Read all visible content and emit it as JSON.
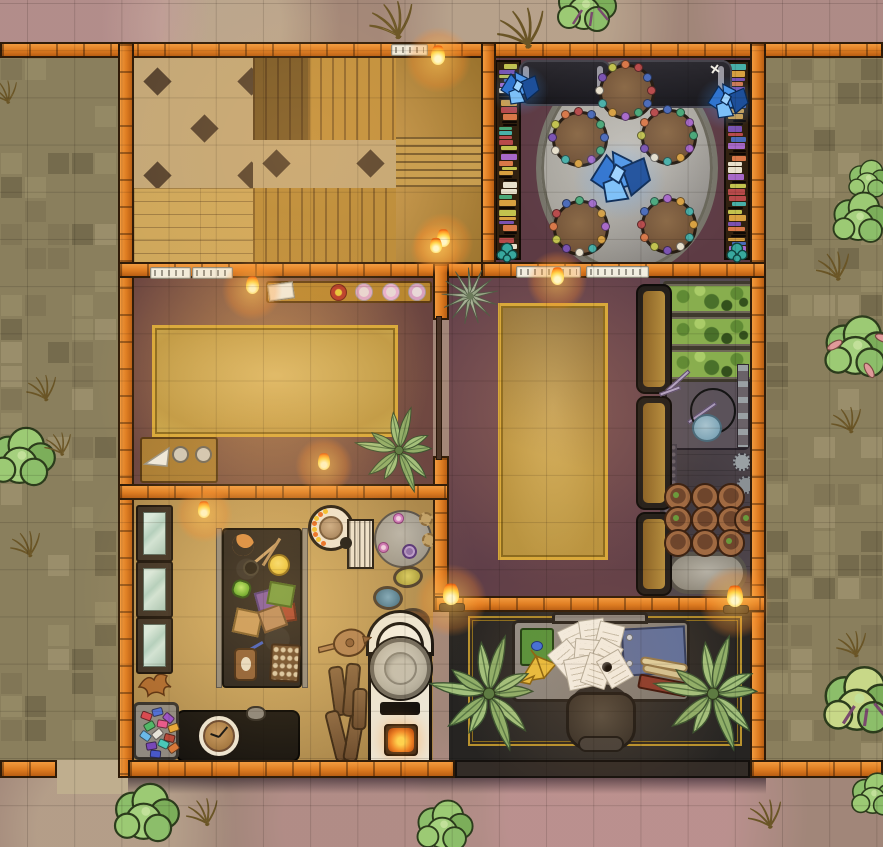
{
  "map": {
    "width": 883,
    "height": 847,
    "grid_px": 47.2,
    "style": "top-down fantasy battlemap, walled guild house with courtyards"
  },
  "palette": {
    "wall_orange": "#dd7b20",
    "wall_outline": "#2f1b08",
    "dirt": "#a18679",
    "dirt_light": "#c0ad93",
    "dirt_pink": "#c795a0",
    "path_tan": "#bfae8e",
    "cobble": "#8a7f5d",
    "hall_wood": "#c2913e",
    "checker_tan": "#c4a878",
    "checker_dark": "#584430",
    "library_floor": "#5d3b44",
    "oval_rug": "#b5b2aa",
    "bench_black": "#232127",
    "dining_floor": "#6e4743",
    "lounge_floor": "#66414e",
    "rug_gold": "#cfa94e",
    "rug_trim": "#d8a93a",
    "greenhouse_floor": "#554b52",
    "bed_green": "#88ae4e",
    "pot_terracotta": "#a06a42",
    "workshop_floor": "#b39250",
    "craft_table_black": "#201c1a",
    "glass": "#bcd8cc",
    "kiln_white": "#ece6d6",
    "office_floor": "#2d2b29",
    "desk_gray": "#8b8681",
    "crystal_blue": "#3f8ae0",
    "flame_orange": "#ff9422",
    "fern_green": "#8fae69",
    "bush_green": "#8cbe6a",
    "teal_plant": "#38a89e",
    "wheat_tan": "#d4b874"
  },
  "rooms": [
    {
      "id": "hall",
      "x": 134,
      "y": 58,
      "w": 347,
      "h": 204
    },
    {
      "id": "library",
      "x": 496,
      "y": 58,
      "w": 254,
      "h": 204
    },
    {
      "id": "dining",
      "x": 134,
      "y": 278,
      "w": 299,
      "h": 206
    },
    {
      "id": "lounge",
      "x": 449,
      "y": 278,
      "w": 211,
      "h": 318
    },
    {
      "id": "greenhouse",
      "x": 660,
      "y": 278,
      "w": 90,
      "h": 318
    },
    {
      "id": "workshop",
      "x": 134,
      "y": 500,
      "w": 299,
      "h": 262
    },
    {
      "id": "office",
      "x": 449,
      "y": 612,
      "w": 301,
      "h": 150
    }
  ],
  "walls": [
    {
      "x": 0,
      "y": 42,
      "w": 883,
      "h": 16,
      "v": 0
    },
    {
      "x": 118,
      "y": 42,
      "w": 16,
      "h": 736,
      "v": 1
    },
    {
      "x": 750,
      "y": 42,
      "w": 16,
      "h": 736,
      "v": 1
    },
    {
      "x": 481,
      "y": 42,
      "w": 15,
      "h": 236,
      "v": 1
    },
    {
      "x": 118,
      "y": 262,
      "w": 378,
      "h": 16,
      "v": 0
    },
    {
      "x": 481,
      "y": 262,
      "w": 285,
      "h": 16,
      "v": 0
    },
    {
      "x": 433,
      "y": 262,
      "w": 16,
      "h": 58,
      "v": 1
    },
    {
      "x": 433,
      "y": 456,
      "w": 16,
      "h": 156,
      "v": 1
    },
    {
      "x": 118,
      "y": 484,
      "w": 331,
      "h": 16,
      "v": 0
    },
    {
      "x": 433,
      "y": 596,
      "w": 333,
      "h": 16,
      "v": 0
    },
    {
      "x": 0,
      "y": 760,
      "w": 57,
      "h": 18,
      "v": 0
    },
    {
      "x": 128,
      "y": 760,
      "w": 327,
      "h": 18,
      "v": 0
    },
    {
      "x": 455,
      "y": 760,
      "w": 295,
      "h": 18,
      "v": 0,
      "dark": 1
    },
    {
      "x": 750,
      "y": 760,
      "w": 133,
      "h": 18,
      "v": 0
    }
  ],
  "scene": {
    "yards": [
      {
        "x": 0,
        "y": 58,
        "w": 118,
        "h": 702,
        "seed": 7
      },
      {
        "x": 766,
        "y": 58,
        "w": 117,
        "h": 702,
        "seed": 13
      }
    ],
    "flames": [
      {
        "x": 438,
        "y": 58,
        "s": 1.1
      },
      {
        "x": 443,
        "y": 241,
        "s": 1.0
      },
      {
        "x": 252,
        "y": 288,
        "s": 1.0
      },
      {
        "x": 557,
        "y": 279,
        "s": 1.0
      },
      {
        "x": 436,
        "y": 248,
        "s": 0.85
      },
      {
        "x": 324,
        "y": 464,
        "s": 0.95
      },
      {
        "x": 204,
        "y": 512,
        "s": 0.95
      },
      {
        "x": 451,
        "y": 598,
        "s": 1.2
      },
      {
        "x": 735,
        "y": 600,
        "s": 1.2
      }
    ],
    "trims": [
      {
        "x": 150,
        "y": 267,
        "w": 39
      },
      {
        "x": 192,
        "y": 267,
        "w": 39
      },
      {
        "x": 516,
        "y": 266,
        "w": 63
      },
      {
        "x": 586,
        "y": 266,
        "w": 61
      },
      {
        "x": 391,
        "y": 44,
        "w": 35
      }
    ],
    "library": {
      "tables": [
        {
          "x": 624,
          "y": 89
        },
        {
          "x": 577,
          "y": 136
        },
        {
          "x": 666,
          "y": 134
        },
        {
          "x": 578,
          "y": 225
        },
        {
          "x": 666,
          "y": 223
        }
      ],
      "table_r": 25,
      "crystals": [
        {
          "x": 519,
          "y": 90,
          "s": 1.0
        },
        {
          "x": 727,
          "y": 103,
          "s": 1.05
        },
        {
          "x": 619,
          "y": 180,
          "s": 1.55
        }
      ],
      "benches": [
        {
          "x": 519,
          "y": 60,
          "w": 88,
          "h": 42
        },
        {
          "x": 616,
          "y": 60,
          "w": 112,
          "h": 44
        }
      ],
      "shelves": [
        {
          "x": 495,
          "y": 60,
          "w": 26,
          "h": 200
        },
        {
          "x": 724,
          "y": 60,
          "w": 26,
          "h": 200
        }
      ],
      "spine_colors": [
        "#b84a4a",
        "#4a6ab8",
        "#4aa878",
        "#a868c8",
        "#d8a040",
        "#48b0a8",
        "#e8e0cc",
        "#7a52b0",
        "#c2c24e",
        "#d87848"
      ]
    },
    "kitchen": {
      "beds": [
        {
          "x": 663,
          "y": 281
        },
        {
          "x": 663,
          "y": 314
        },
        {
          "x": 663,
          "y": 347
        }
      ],
      "bed_w": 88,
      "bed_h": 29,
      "pots": [
        [
          676,
          495
        ],
        [
          703,
          495
        ],
        [
          729,
          495
        ],
        [
          676,
          518
        ],
        [
          703,
          518
        ],
        [
          729,
          518
        ],
        [
          746,
          518
        ],
        [
          676,
          541
        ],
        [
          703,
          541
        ],
        [
          729,
          541
        ]
      ],
      "pot_r": 12,
      "booths": [
        {
          "y": 284,
          "h": 106
        },
        {
          "y": 396,
          "h": 110
        },
        {
          "y": 512,
          "h": 80
        }
      ],
      "booth_x": 636,
      "booth_w": 32
    },
    "workshop": {
      "cases": [
        505,
        561,
        617
      ],
      "case_x": 136,
      "case_w": 33,
      "case_h": 53,
      "dial": {
        "cx": 331,
        "cy": 528,
        "r": 17
      },
      "gems": [
        {
          "x": 141,
          "y": 712,
          "c": "#d84850",
          "r": 20
        },
        {
          "x": 152,
          "y": 708,
          "c": "#4e6ed8",
          "r": -15
        },
        {
          "x": 163,
          "y": 714,
          "c": "#9a50c8",
          "r": 40
        },
        {
          "x": 144,
          "y": 722,
          "c": "#50b868",
          "r": -30
        },
        {
          "x": 157,
          "y": 720,
          "c": "#e8588c",
          "r": 10
        },
        {
          "x": 168,
          "y": 724,
          "c": "#e8a838",
          "r": -20
        },
        {
          "x": 140,
          "y": 732,
          "c": "#6ab8e8",
          "r": 35
        },
        {
          "x": 152,
          "y": 730,
          "c": "#e8e4da",
          "r": -40
        },
        {
          "x": 164,
          "y": 734,
          "c": "#b84838",
          "r": 15
        },
        {
          "x": 146,
          "y": 742,
          "c": "#7848b8",
          "r": -10
        },
        {
          "x": 158,
          "y": 740,
          "c": "#48c8b8",
          "r": 25
        },
        {
          "x": 168,
          "y": 744,
          "c": "#d87838",
          "r": -35
        },
        {
          "x": 150,
          "y": 750,
          "c": "#4858c8",
          "r": 5
        }
      ],
      "logs": [
        {
          "x": 331,
          "y": 666,
          "h": 46,
          "r": -8
        },
        {
          "x": 344,
          "y": 663,
          "h": 50,
          "r": 5
        },
        {
          "x": 330,
          "y": 710,
          "h": 48,
          "r": -14
        },
        {
          "x": 346,
          "y": 714,
          "h": 44,
          "r": 10
        },
        {
          "x": 352,
          "y": 688,
          "h": 38,
          "r": 2
        }
      ]
    },
    "office": {
      "papers": [
        {
          "x": 574,
          "y": 640,
          "r": -25
        },
        {
          "x": 592,
          "y": 634,
          "r": -8
        },
        {
          "x": 608,
          "y": 638,
          "r": 14
        },
        {
          "x": 566,
          "y": 658,
          "r": -40
        },
        {
          "x": 586,
          "y": 654,
          "r": 5
        },
        {
          "x": 604,
          "y": 656,
          "r": 28
        },
        {
          "x": 578,
          "y": 672,
          "r": -12
        },
        {
          "x": 596,
          "y": 670,
          "r": 18
        },
        {
          "x": 614,
          "y": 668,
          "r": -30
        }
      ]
    },
    "flora": [
      {
        "t": "wheat",
        "x": 398,
        "y": 20,
        "s": 1.3
      },
      {
        "t": "wheat",
        "x": 528,
        "y": 28,
        "s": 1.4
      },
      {
        "t": "tree",
        "x": 588,
        "y": 10,
        "s": 1.0
      },
      {
        "t": "wheat",
        "x": 8,
        "y": 92,
        "s": 0.8
      },
      {
        "t": "bush",
        "x": 870,
        "y": 182,
        "s": 0.7
      },
      {
        "t": "bush",
        "x": 862,
        "y": 222,
        "s": 0.95
      },
      {
        "t": "wheat",
        "x": 838,
        "y": 266,
        "s": 1.0
      },
      {
        "t": "bushpink",
        "x": 860,
        "y": 352,
        "s": 1.15
      },
      {
        "t": "wheat",
        "x": 851,
        "y": 420,
        "s": 0.9
      },
      {
        "t": "wheat",
        "x": 856,
        "y": 644,
        "s": 0.9
      },
      {
        "t": "tree2",
        "x": 862,
        "y": 706,
        "s": 1.25
      },
      {
        "t": "wheat",
        "x": 770,
        "y": 814,
        "s": 1.0
      },
      {
        "t": "bush",
        "x": 148,
        "y": 818,
        "s": 1.1
      },
      {
        "t": "wheat",
        "x": 207,
        "y": 812,
        "s": 0.95
      },
      {
        "t": "bush",
        "x": 446,
        "y": 830,
        "s": 0.95
      },
      {
        "t": "bush",
        "x": 876,
        "y": 798,
        "s": 0.8
      },
      {
        "t": "bush",
        "x": 24,
        "y": 462,
        "s": 1.1
      },
      {
        "t": "wheat",
        "x": 46,
        "y": 388,
        "s": 0.9
      },
      {
        "t": "wheat",
        "x": 62,
        "y": 444,
        "s": 0.8
      },
      {
        "t": "wheat",
        "x": 30,
        "y": 544,
        "s": 0.9
      },
      {
        "t": "fern",
        "x": 399,
        "y": 452,
        "s": 0.85
      },
      {
        "t": "fern",
        "x": 489,
        "y": 696,
        "s": 1.15
      },
      {
        "t": "fern",
        "x": 713,
        "y": 696,
        "s": 1.15
      },
      {
        "t": "spiky",
        "x": 470,
        "y": 298,
        "s": 1.0
      },
      {
        "t": "teal",
        "x": 507,
        "y": 254,
        "s": 0.9
      },
      {
        "t": "teal",
        "x": 737,
        "y": 254,
        "s": 0.9
      }
    ],
    "glows": [
      {
        "x": 300,
        "y": 150,
        "r": 190,
        "c": "rgba(255,190,100,.16)"
      },
      {
        "x": 270,
        "y": 385,
        "r": 175,
        "c": "rgba(255,185,95,.22)"
      },
      {
        "x": 560,
        "y": 420,
        "r": 160,
        "c": "rgba(255,170,80,.12)"
      },
      {
        "x": 280,
        "y": 592,
        "r": 200,
        "c": "rgba(255,200,110,.24)"
      },
      {
        "x": 600,
        "y": 665,
        "r": 150,
        "c": "rgba(255,160,70,.10)"
      },
      {
        "x": 628,
        "y": 160,
        "r": 120,
        "c": "rgba(205,215,255,.06)"
      }
    ]
  }
}
